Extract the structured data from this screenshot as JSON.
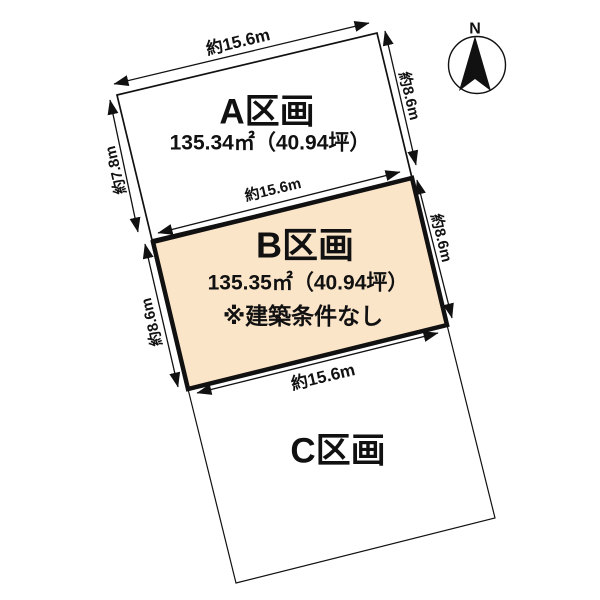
{
  "compass": {
    "label": "N"
  },
  "plots": {
    "a": {
      "name": "A区画",
      "area": "135.34㎡（40.94坪）"
    },
    "b": {
      "name": "B区画",
      "area": "135.35㎡（40.94坪）",
      "note": "※建築条件なし"
    },
    "c": {
      "name": "C区画"
    }
  },
  "dimensions": {
    "a_top": "約15.6m",
    "a_left": "約7.8m",
    "a_right": "約8.6m",
    "b_top": "約15.6m",
    "b_left": "約8.6m",
    "b_right": "約8.6m",
    "b_bottom": "約15.6m"
  },
  "colors": {
    "background": "#ffffff",
    "line": "#111111",
    "plot_b_fill": "#fbe5c9",
    "plot_ac_fill": "#ffffff"
  }
}
